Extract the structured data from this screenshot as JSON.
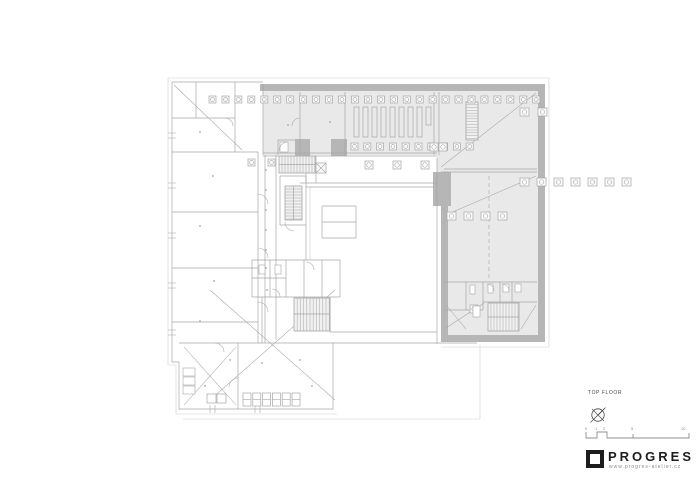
{
  "colors": {
    "highlight_wall": "#b6b6b6",
    "highlight_fill": "#e9e9e9",
    "plan_line": "#a6a6a6",
    "plan_faint": "#cfcfcf",
    "ink": "#1d1d1b",
    "annotation": "#8a8a8a"
  },
  "drawing": {
    "type": "architectural floor plan",
    "highlighted_zone": "top band and right wing shown with thick grey walls"
  },
  "title_block": {
    "floor_label": "TOP FLOOR",
    "logo_text": "PROGRES",
    "website": "www.progres-atelier.cz",
    "scale_labels": [
      "0",
      "1",
      "2",
      "5",
      "10"
    ],
    "icons": [
      "north-arrow-icon",
      "scale-bar-icon",
      "logo-square-icon"
    ]
  }
}
